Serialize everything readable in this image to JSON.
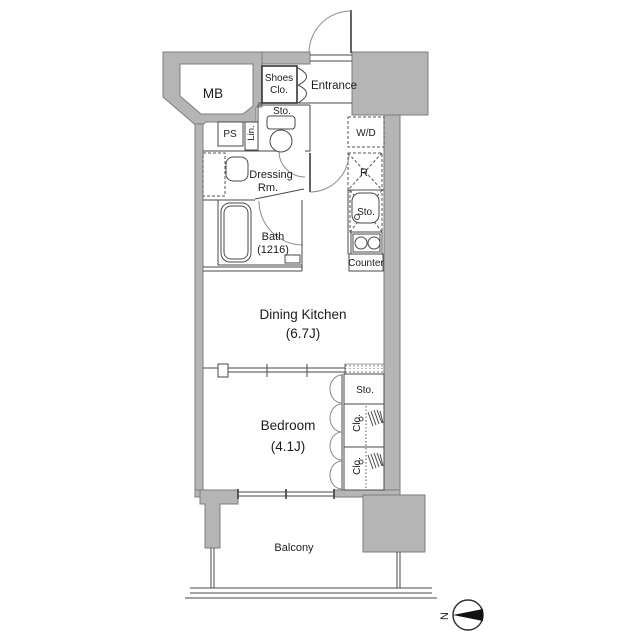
{
  "colors": {
    "background": "#ffffff",
    "wall_fill": "#b5b5b5",
    "wall_stroke": "#7d7d7d",
    "line": "#4a4a4a",
    "text": "#1c1c1c",
    "compass_arrow": "#111111"
  },
  "labels": {
    "mb": "MB",
    "ps": "PS",
    "lin": "Lin.",
    "shoes_line1": "Shoes",
    "shoes_line2": "Clo.",
    "entrance": "Entrance",
    "toilet_sto": "Sto.",
    "wd": "W/D",
    "dressing_line1": "Dressing",
    "dressing_line2": "Rm.",
    "fridge": "R",
    "kitchen_sto": "Sto.",
    "counter": "Counter",
    "bath_line1": "Bath",
    "bath_line2": "(1216)",
    "dining_kitchen_line1": "Dining Kitchen",
    "dining_kitchen_line2": "(6.7J)",
    "bedroom_line1": "Bedroom",
    "bedroom_line2": "(4.1J)",
    "bedroom_sto": "Sto.",
    "clo1": "Clo.",
    "clo2": "Clo.",
    "balcony": "Balcony",
    "compass_north": "N"
  }
}
